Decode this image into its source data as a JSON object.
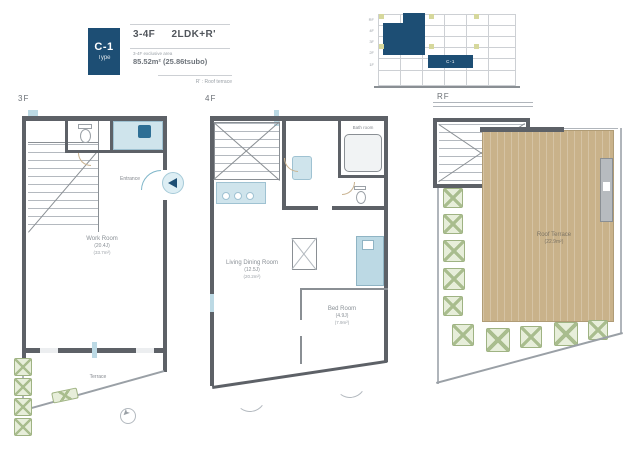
{
  "header": {
    "type_code": "C-1",
    "type_label": "Type",
    "floors": "3-4F",
    "layout": "2LDK+R'",
    "area_note": "3-4F exclusive area",
    "area_value": "85.52m² (25.86tsubo)",
    "footnote": "R' : Roof terrace"
  },
  "key_plan": {
    "unit_label": "C-1",
    "floor_labels": [
      "RF",
      "4F",
      "3F",
      "2F",
      "1F"
    ]
  },
  "plans": {
    "f3": {
      "label": "3F",
      "entrance_label": "Entrance",
      "terrace_label": "Terrace",
      "room": {
        "name": "Work Room",
        "size_jo": "(20.4J)",
        "size_m2": "(33.7m²)"
      }
    },
    "f4": {
      "label": "4F",
      "bath_label": "Bath room",
      "living": {
        "name": "Living Dining Room",
        "size_jo": "(12.5J)",
        "size_m2": "(20.2m²)"
      },
      "bed": {
        "name": "Bed Room",
        "size_jo": "(4.9J)",
        "size_m2": "(7.9m²)"
      }
    },
    "rf": {
      "label": "RF",
      "terrace": {
        "name": "Roof Terrace",
        "size_m2": "(22.9m²)"
      }
    }
  },
  "colors": {
    "accent_navy": "#1d4e74",
    "fixture_blue": "#cfe4ec",
    "deck_tan": "#c9b28a",
    "planter_green": "#a9bd8e"
  }
}
